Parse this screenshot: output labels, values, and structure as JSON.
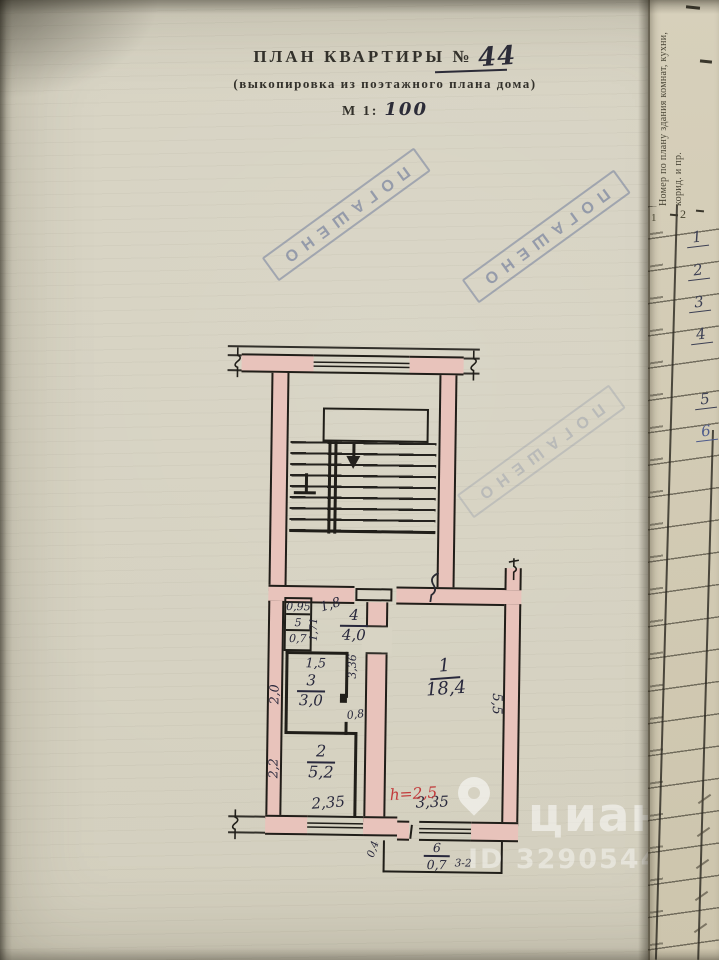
{
  "header": {
    "title": "ПЛАН КВАРТИРЫ №",
    "apartment_number": "44",
    "subtitle": "(выкопировка из поэтажного плана дома)",
    "scale_prefix": "М 1:",
    "scale_value": "100"
  },
  "stamp": {
    "text": "ПОГАШЕНО"
  },
  "colors": {
    "wall_fill": "#e8c3bb",
    "stamp_blue": "#5d6c94",
    "ink": "#28283c",
    "red_ink": "#c23b3b",
    "paper": "#d8d4c4"
  },
  "plan": {
    "rooms": {
      "r1": {
        "no": "1",
        "area": "18,4"
      },
      "r2": {
        "no": "2",
        "area": "5,2"
      },
      "r3": {
        "no": "3",
        "area": "3,0"
      },
      "r4": {
        "no": "4",
        "area": "4,0"
      },
      "r5": {
        "no": "5",
        "area": "0,7",
        "width": "0,95"
      },
      "r6": {
        "no": "6",
        "area": "0,7"
      }
    },
    "dims": {
      "hall_door": "1,8",
      "toilet_depth": "1,71",
      "corridor_length": "3,36",
      "room3_width": "1,5",
      "room3_depth": "2,0",
      "room3_door": "0,8",
      "room2_depth": "2,2",
      "kitchen_window": "2,35",
      "room1_depth": "5,5",
      "room1_window": "3,35",
      "balcony_depth": "0,4",
      "balcony_mark": "3-2",
      "ceiling_height": "h=2,5"
    }
  },
  "side_table": {
    "header": "Номер по плану здания комнат, кухни, корид. и пр.",
    "col_left": "1",
    "col_right": "2",
    "rows": [
      "1",
      "2",
      "3",
      "4",
      "5",
      "6"
    ]
  },
  "watermark": {
    "brand": "циан",
    "id_text": "ID 329054459"
  }
}
